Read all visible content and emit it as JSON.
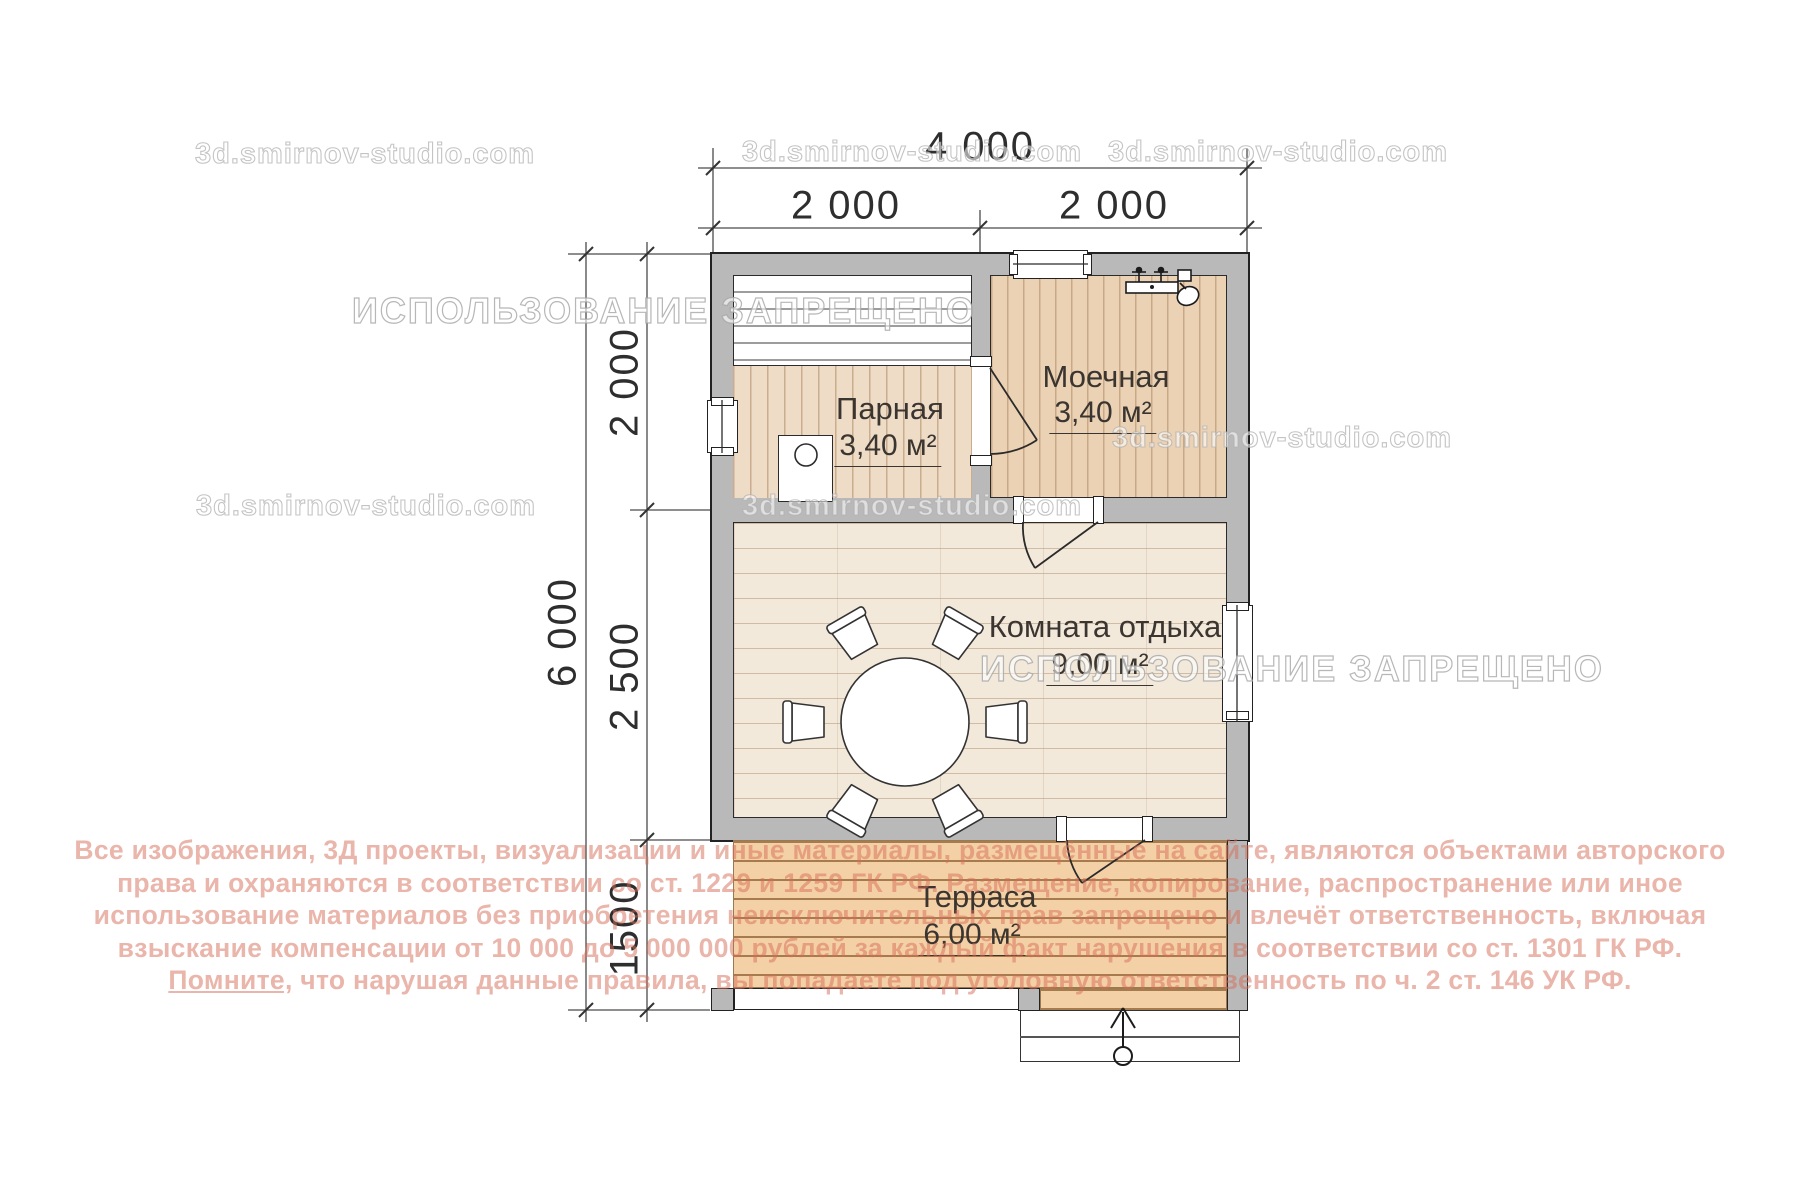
{
  "watermarks": {
    "site": "3d.smirnov-studio.com",
    "forbidden": "ИСПОЛЬЗОВАНИЕ ЗАПРЕЩЕНО"
  },
  "dimensions": {
    "top_total": "4 000",
    "top_seg1": "2 000",
    "top_seg2": "2 000",
    "left_total": "6 000",
    "left_seg1": "2 000",
    "left_seg2": "2 500",
    "left_seg3": "1500"
  },
  "rooms": {
    "parnaya": {
      "name": "Парная",
      "area": "3,40 м²"
    },
    "moechnaya": {
      "name": "Моечная",
      "area": "3,40 м²"
    },
    "rest": {
      "name": "Комната отдыха",
      "area": "9,00 м²"
    },
    "terrace": {
      "name": "Терраса",
      "area": "6,00 м²"
    }
  },
  "copyright": {
    "line1": "Все изображения, 3Д проекты, визуализации и иные материалы, размещённые на сайте, являются объектами авторского",
    "line2": "права и охраняются в соответствии со ст. 1229 и 1259 ГК РФ. Размещение, копирование, распространение или иное",
    "line3": "использование материалов без приобретения неисключительных прав запрещено и влечёт ответственность, включая",
    "line4": "взыскание компенсации от 10 000 до 5 000 000 рублей за каждый факт нарушения в соответствии со ст. 1301 ГК РФ.",
    "line5_underlined": "Помните,",
    "line5_rest": " что нарушая данные правила, вы попадаете под уголовную ответственность по ч. 2 ст. 146 УК РФ."
  }
}
